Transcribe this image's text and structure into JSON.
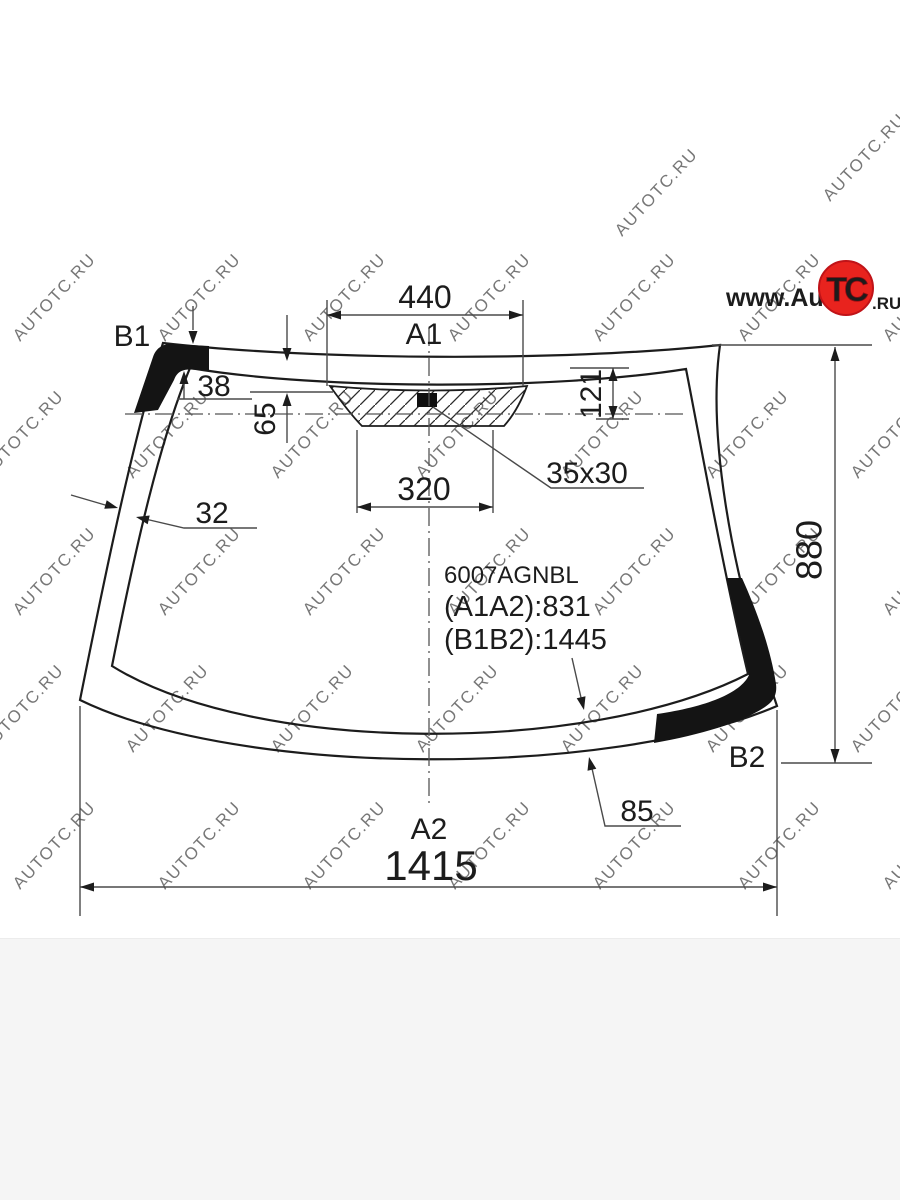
{
  "page": {
    "background": "#ffffff",
    "footer_background": "#f5f5f5"
  },
  "watermark": {
    "text": "AUTOTC.RU",
    "color": "#c9cbce"
  },
  "logo": {
    "www_auto": "www.Auto",
    "tc": "TC",
    "ru": ".RU",
    "circle_color": "#e8231e"
  },
  "part": {
    "number": "6007AGNBL",
    "a1a2": "(A1A2):831",
    "b1b2": "(B1B2):1445"
  },
  "corner_labels": {
    "a1": "A1",
    "a2": "A2",
    "b1": "B1",
    "b2": "B2"
  },
  "dimensions": {
    "top_opening_width": "440",
    "band_top_width": "38",
    "sensor_offset": "65",
    "pad_height": "121",
    "pad_bottom_width": "320",
    "sensor_size": "35x30",
    "band_side_width": "32",
    "glass_height": "880",
    "band_bottom_width": "85",
    "glass_bottom_width": "1415"
  },
  "colors": {
    "line": "#1c1c1c",
    "dim_line": "#4a4a4a",
    "accent_red": "#e8231e"
  }
}
